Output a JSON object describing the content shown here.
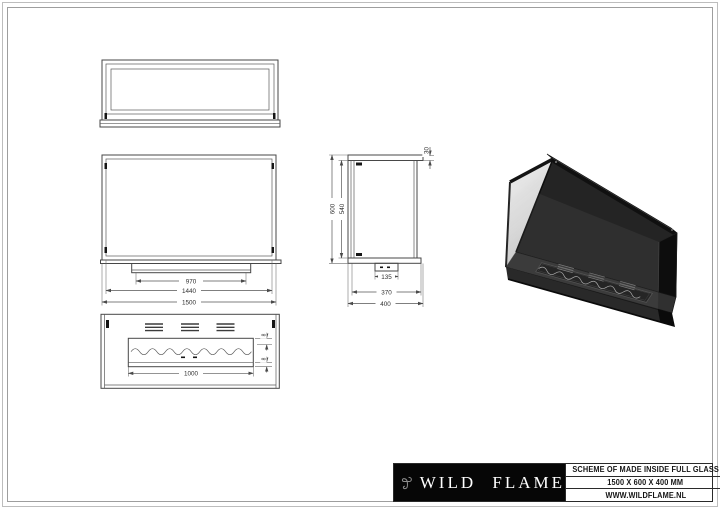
{
  "page": {
    "background": "#ffffff"
  },
  "drawing": {
    "line_color": "#474747",
    "dims": {
      "front": {
        "burner": "970",
        "inner_width": "1440",
        "overall_width": "1500"
      },
      "side": {
        "overall_height": "600",
        "glass_height": "540",
        "top_lip": "30",
        "burner_box": "135",
        "inner_depth": "370",
        "overall_depth": "400"
      },
      "bottom": {
        "burner_length": "1000",
        "tray_lip_top": "8",
        "tray_lip_bottom": "8"
      }
    }
  },
  "title_block": {
    "brand": "WILD FLAME",
    "logo": "wildflame-logo",
    "scheme_line": "SCHEME OF MADE INSIDE FULL GLASS",
    "size_line": "1500 X 600 X 400 MM",
    "website_line": "WWW.WILDFLAME.NL",
    "colors": {
      "panel_bg": "#060606",
      "panel_text": "#ffffff",
      "logo_gray": "#8d8d8d"
    }
  }
}
